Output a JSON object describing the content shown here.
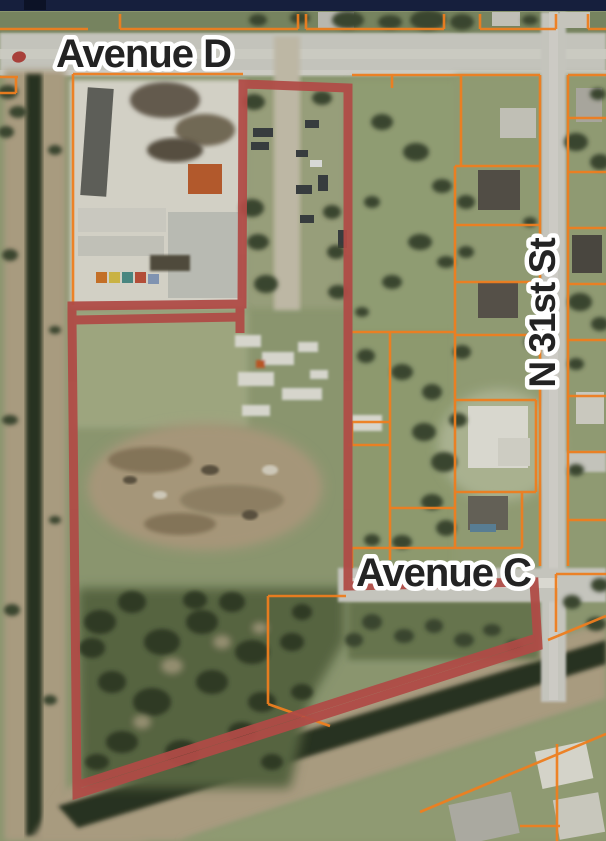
{
  "map": {
    "street_labels": [
      {
        "id": "avenue-d",
        "text": "Avenue D"
      },
      {
        "id": "avenue-c",
        "text": "Avenue C"
      },
      {
        "id": "n-31st-st",
        "text": "N 31st St"
      }
    ],
    "colors": {
      "top_bar": "#161f3d",
      "parcel_line": "#ee7e1f",
      "selection_outline": "#b04b46",
      "marker": "#a8403a",
      "road": "#d3d2cd",
      "canal": "#2c3424",
      "label_fill": "#232323",
      "label_halo": "#ffffff"
    }
  }
}
